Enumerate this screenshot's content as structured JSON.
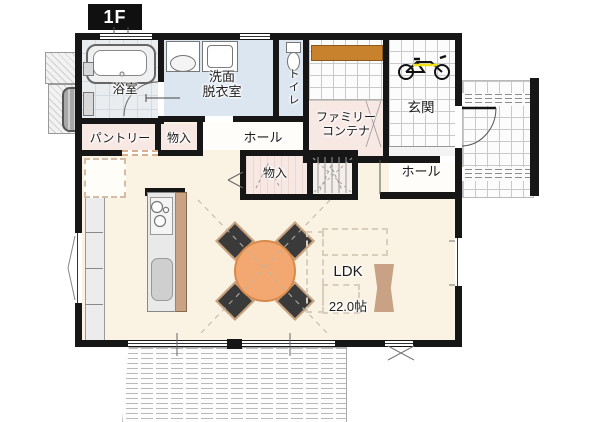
{
  "header": {
    "floor_label": "1F"
  },
  "rooms": {
    "bathroom": {
      "label": "浴室"
    },
    "washroom": {
      "label": "洗面\n脱衣室"
    },
    "toilet": {
      "label": "トイレ"
    },
    "pantry": {
      "label": "パントリー"
    },
    "storage_upper": {
      "label": "物入"
    },
    "hall_upper": {
      "label": "ホール"
    },
    "family_container": {
      "label": "ファミリー\nコンテナ"
    },
    "storage_center": {
      "label": "物入"
    },
    "hall_entry": {
      "label": "ホール"
    },
    "entrance": {
      "label": "玄関"
    },
    "ldk": {
      "label": "LDK",
      "area": "22.0帖"
    }
  },
  "icons": {
    "bathtub": "bathtub-icon",
    "vanity": "vanity-sink-icon",
    "washer": "washing-machine-icon",
    "toilet": "toilet-icon",
    "bicycle": "bicycle-icon",
    "stove": "stove-burners-icon",
    "kitchen_sink": "kitchen-sink-icon",
    "dining_table": "dining-table-icon",
    "water_heater": "water-heater-tank-icon"
  },
  "colors": {
    "wall": "#161616",
    "ldk_floor": "#faf2e2",
    "wet_room_floor": "#dbe6f1",
    "closet_floor": "#f8e8e4",
    "accent_wood": "#c8822e",
    "counter_wood": "#c9a184",
    "table": "#f3a871",
    "chair": "#3a3a3a"
  }
}
